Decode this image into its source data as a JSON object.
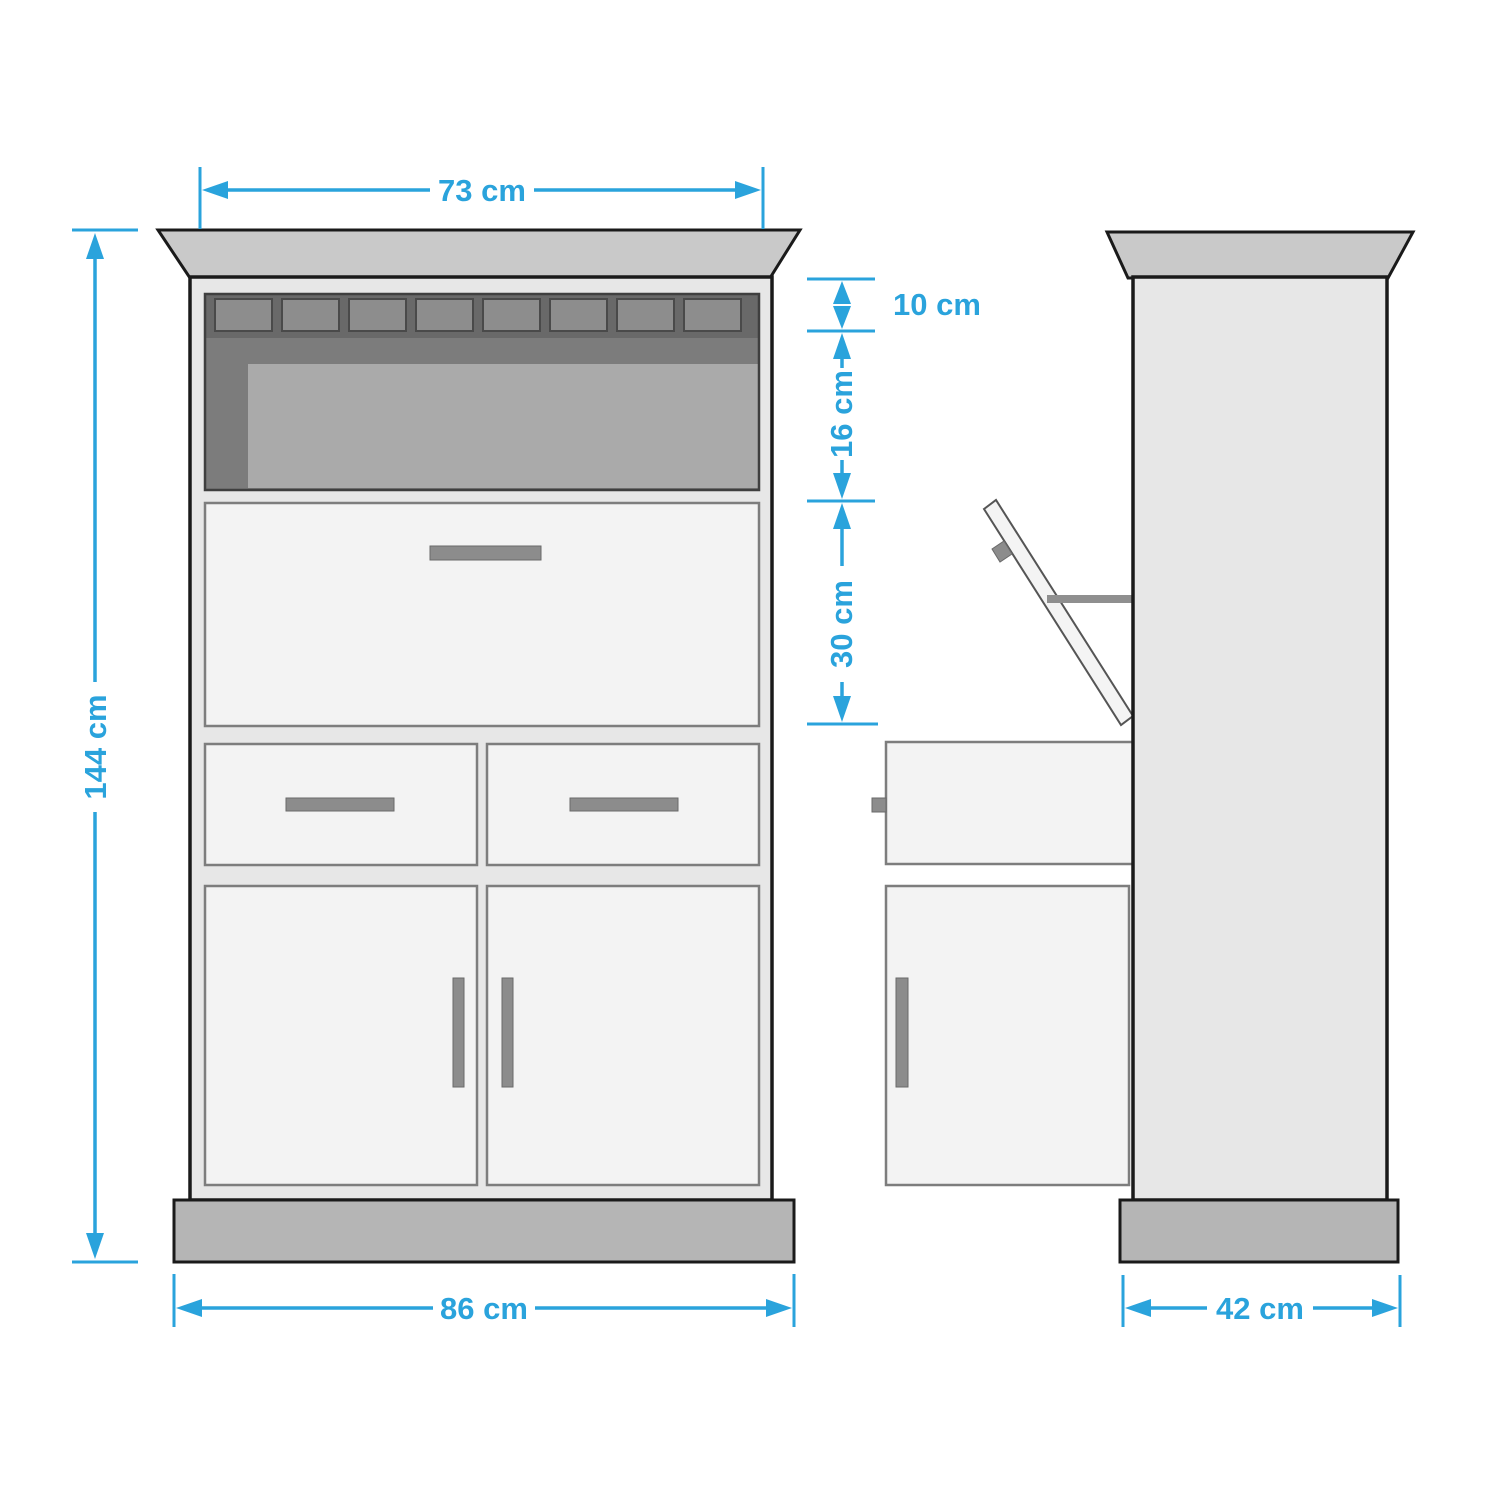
{
  "diagram": {
    "type": "furniture-dimension-drawing",
    "views": {
      "front": "front-view",
      "side": "side-view"
    }
  },
  "dimensions": {
    "top_width": "73 cm",
    "overall_height": "144 cm",
    "rack_section_height": "10 cm",
    "compartment_height": "16 cm",
    "flap_section_height": "30 cm",
    "base_width": "86 cm",
    "depth": "42 cm"
  },
  "colors": {
    "accent": "#2aa3dc",
    "outline": "#1a1a1a",
    "crown": "#c9c9c9",
    "plinth": "#b5b5b5",
    "body": "#e7e7e7",
    "panel": "#f3f3f3",
    "panel_border": "#7d7d7d",
    "handle": "#8c8c8c",
    "compartment": "#7c7c7c",
    "rack_band": "#696969",
    "rack_cell": "#8d8d8d",
    "interior": "#aaaaaa"
  }
}
